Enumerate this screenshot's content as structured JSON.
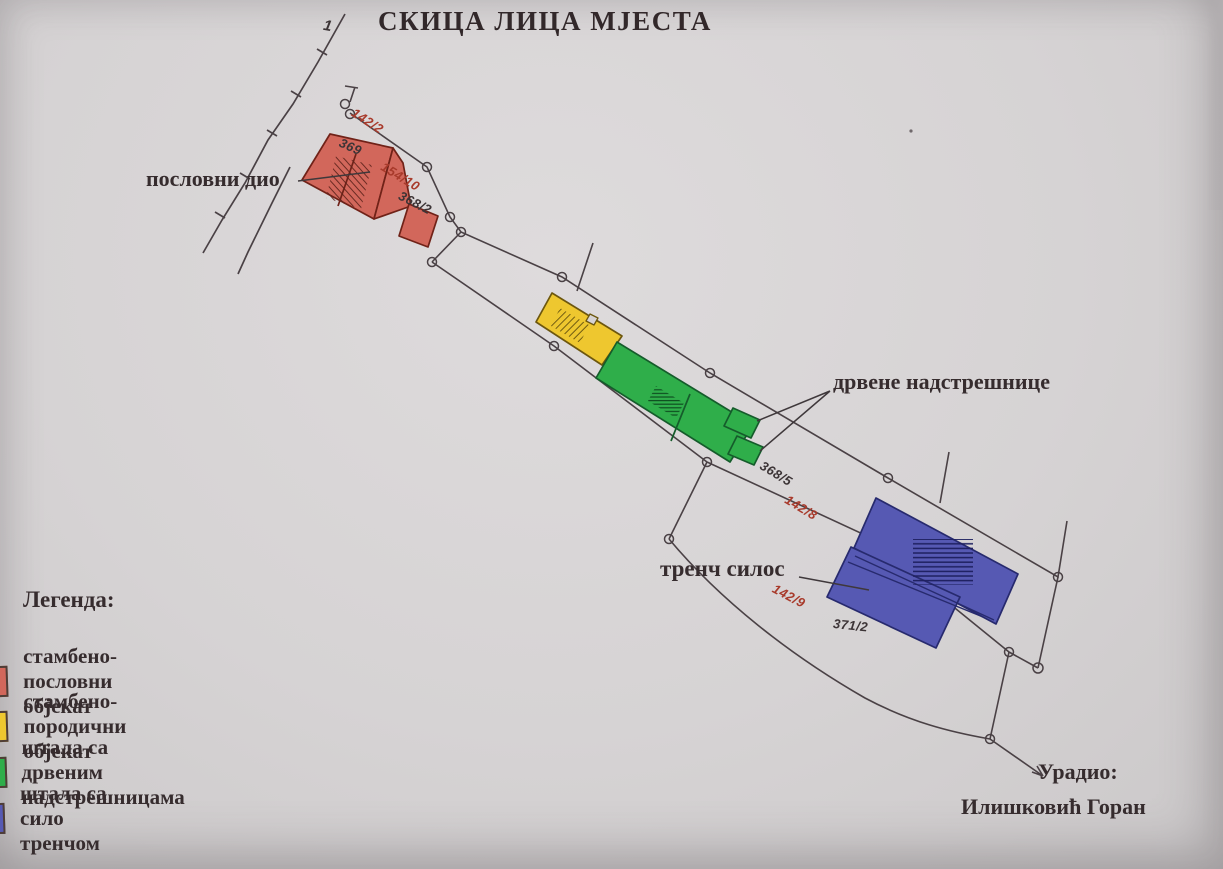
{
  "title": "СКИЦА ЛИЦА МЈЕСТА",
  "road_marker": "1",
  "labels": {
    "business_part": "пословни дио",
    "wooden_canopies": "дрвене надстрешнице",
    "trench_silo": "тренч силос"
  },
  "parcels": [
    {
      "number": "142/2",
      "color": "#a83a2b"
    },
    {
      "number": "369",
      "color": "#3c3436"
    },
    {
      "number": "154/10",
      "color": "#a83a2b"
    },
    {
      "number": "368/2",
      "color": "#3c3436"
    },
    {
      "number": "368/5",
      "color": "#3c3436"
    },
    {
      "number": "142/8",
      "color": "#a83a2b"
    },
    {
      "number": "142/9",
      "color": "#a83a2b"
    },
    {
      "number": "371/2",
      "color": "#3c3436"
    }
  ],
  "legend": {
    "heading": "Легенда:",
    "items": [
      {
        "label": "стамбено-пословни објекат",
        "color": "#d2675b"
      },
      {
        "label": "стамбено-породични објекат",
        "color": "#eec72f"
      },
      {
        "label": "штала са дрвеним надстрешницама",
        "color": "#2fae4a"
      },
      {
        "label": "штала са сило тренчом",
        "color": "#5659b3"
      }
    ]
  },
  "credit": {
    "label": "Урадио:",
    "name": "Илишковић Горан"
  },
  "colors": {
    "paper": "#d6d3d4",
    "boundary_line": "#4a4145",
    "text_dark": "#362c2e",
    "parcel_red": "#a83a2b",
    "parcel_black": "#3c3436",
    "building_red": "#d2675b",
    "building_yellow": "#eec72f",
    "building_green": "#2fae4a",
    "building_blue": "#5659b3"
  }
}
